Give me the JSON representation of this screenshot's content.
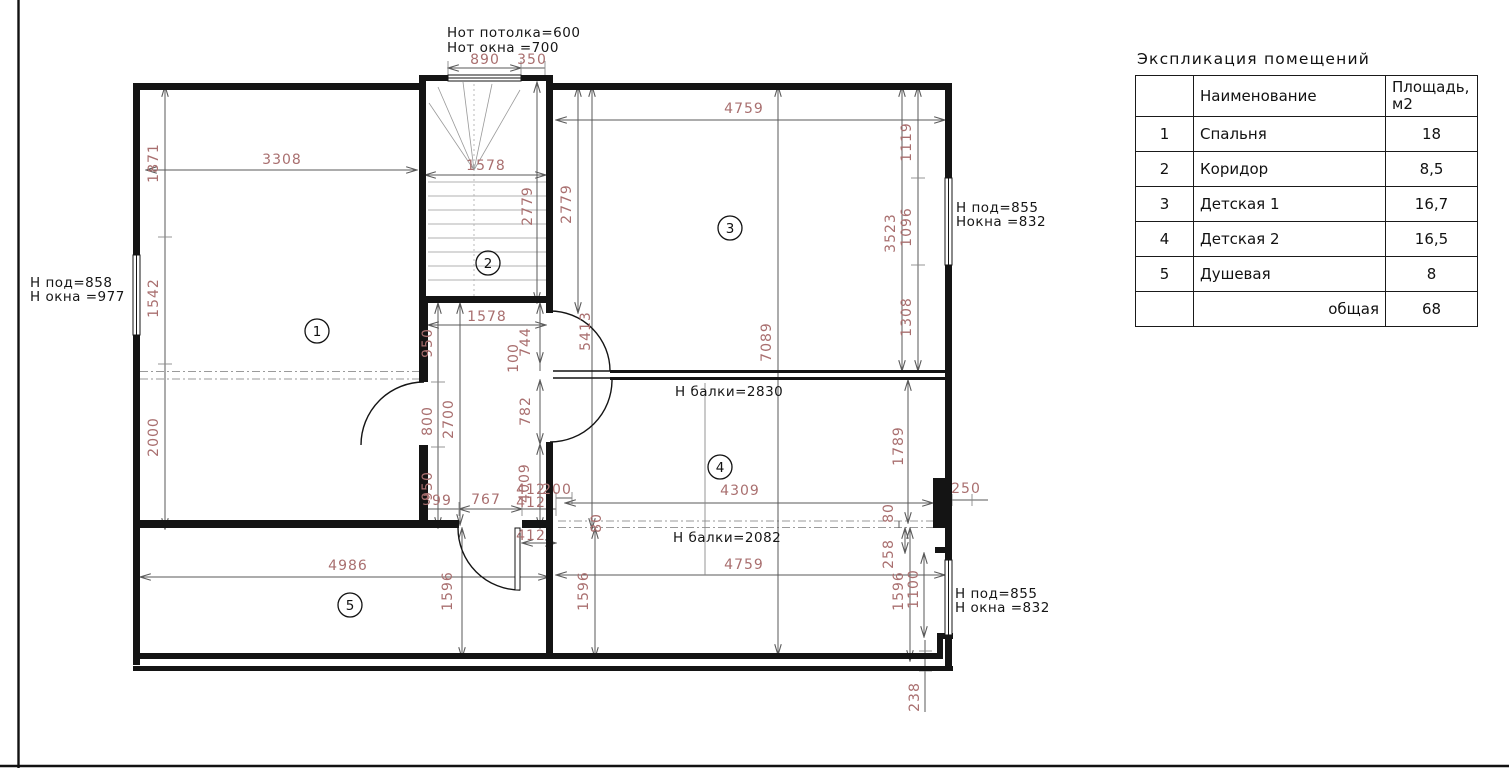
{
  "colors": {
    "dim_text": "#a96f6f",
    "wall": "#141414",
    "dim_line": "#5a5a5a",
    "beam_dash": "#9a9a9a"
  },
  "notes": [
    {
      "t": "Hот потолка=600",
      "x": 447,
      "y": 37
    },
    {
      "t": "Hот окна =700",
      "x": 447,
      "y": 52
    },
    {
      "t": "H под=858",
      "x": 30,
      "y": 287
    },
    {
      "t": "H окна =977",
      "x": 30,
      "y": 301
    },
    {
      "t": "H под=855",
      "x": 956,
      "y": 212
    },
    {
      "t": "Нокна =832",
      "x": 956,
      "y": 226
    },
    {
      "t": "H балки=2830",
      "x": 675,
      "y": 396
    },
    {
      "t": "H балки=2082",
      "x": 673,
      "y": 542
    },
    {
      "t": "H под=855",
      "x": 955,
      "y": 598
    },
    {
      "t": "H окна =832",
      "x": 955,
      "y": 612
    }
  ],
  "dims": [
    {
      "t": "890",
      "x": 485,
      "y": 64,
      "v": false
    },
    {
      "t": "350",
      "x": 532,
      "y": 64,
      "v": false
    },
    {
      "t": "3308",
      "x": 282,
      "y": 164,
      "v": false
    },
    {
      "t": "1578",
      "x": 486,
      "y": 170,
      "v": false
    },
    {
      "t": "4759",
      "x": 744,
      "y": 113,
      "v": false
    },
    {
      "t": "1578",
      "x": 487,
      "y": 321,
      "v": false
    },
    {
      "t": "399",
      "x": 437,
      "y": 505,
      "v": false
    },
    {
      "t": "767",
      "x": 486,
      "y": 504,
      "v": false
    },
    {
      "t": "412",
      "x": 531,
      "y": 494,
      "v": false
    },
    {
      "t": "200",
      "x": 557,
      "y": 494,
      "v": false
    },
    {
      "t": "412",
      "x": 531,
      "y": 507,
      "v": false
    },
    {
      "t": "412",
      "x": 531,
      "y": 540,
      "v": false
    },
    {
      "t": "4309",
      "x": 740,
      "y": 495,
      "v": false
    },
    {
      "t": "4759",
      "x": 744,
      "y": 569,
      "v": false
    },
    {
      "t": "4986",
      "x": 348,
      "y": 570,
      "v": false
    },
    {
      "t": "250",
      "x": 966,
      "y": 493,
      "v": false
    },
    {
      "t": "1871",
      "x": 158,
      "y": 163,
      "v": true
    },
    {
      "t": "1542",
      "x": 158,
      "y": 298,
      "v": true
    },
    {
      "t": "2000",
      "x": 158,
      "y": 437,
      "v": true
    },
    {
      "t": "2779",
      "x": 532,
      "y": 206,
      "v": true
    },
    {
      "t": "2779",
      "x": 571,
      "y": 204,
      "v": true
    },
    {
      "t": "1119",
      "x": 911,
      "y": 142,
      "v": true
    },
    {
      "t": "3523",
      "x": 895,
      "y": 233,
      "v": true
    },
    {
      "t": "1096",
      "x": 911,
      "y": 227,
      "v": true
    },
    {
      "t": "1308",
      "x": 911,
      "y": 317,
      "v": true
    },
    {
      "t": "5413",
      "x": 590,
      "y": 331,
      "v": true
    },
    {
      "t": "7089",
      "x": 771,
      "y": 342,
      "v": true
    },
    {
      "t": "950",
      "x": 432,
      "y": 343,
      "v": true
    },
    {
      "t": "744",
      "x": 530,
      "y": 342,
      "v": true
    },
    {
      "t": "100",
      "x": 518,
      "y": 358,
      "v": true
    },
    {
      "t": "800",
      "x": 432,
      "y": 421,
      "v": true
    },
    {
      "t": "2700",
      "x": 453,
      "y": 419,
      "v": true
    },
    {
      "t": "782",
      "x": 530,
      "y": 411,
      "v": true
    },
    {
      "t": "950",
      "x": 432,
      "y": 486,
      "v": true
    },
    {
      "t": "4009",
      "x": 529,
      "y": 483,
      "v": true
    },
    {
      "t": "80",
      "x": 601,
      "y": 523,
      "v": true
    },
    {
      "t": "1789",
      "x": 903,
      "y": 446,
      "v": true
    },
    {
      "t": "80",
      "x": 893,
      "y": 513,
      "v": true
    },
    {
      "t": "258",
      "x": 893,
      "y": 554,
      "v": true
    },
    {
      "t": "1596",
      "x": 452,
      "y": 591,
      "v": true
    },
    {
      "t": "1596",
      "x": 588,
      "y": 591,
      "v": true
    },
    {
      "t": "1596",
      "x": 903,
      "y": 591,
      "v": true
    },
    {
      "t": "1100",
      "x": 918,
      "y": 589,
      "v": true
    },
    {
      "t": "238",
      "x": 919,
      "y": 697,
      "v": true
    }
  ],
  "rooms": [
    {
      "n": "1",
      "x": 317,
      "y": 331
    },
    {
      "n": "2",
      "x": 488,
      "y": 263
    },
    {
      "n": "3",
      "x": 730,
      "y": 228
    },
    {
      "n": "4",
      "x": 720,
      "y": 467
    },
    {
      "n": "5",
      "x": 350,
      "y": 605
    }
  ],
  "legend": {
    "title": "Экспликация помещений",
    "header": {
      "name": "Наименование",
      "area1": "Площадь,",
      "area2": "м2"
    },
    "rows": [
      {
        "num": "1",
        "name": "Спальня",
        "area": "18",
        "total": false
      },
      {
        "num": "2",
        "name": "Коридор",
        "area": "8,5",
        "total": false
      },
      {
        "num": "3",
        "name": "Детская 1",
        "area": "16,7",
        "total": false
      },
      {
        "num": "4",
        "name": "Детская 2",
        "area": "16,5",
        "total": false
      },
      {
        "num": "5",
        "name": "Душевая",
        "area": "8",
        "total": false
      },
      {
        "num": "",
        "name": "общая",
        "area": "68",
        "total": true
      }
    ]
  }
}
